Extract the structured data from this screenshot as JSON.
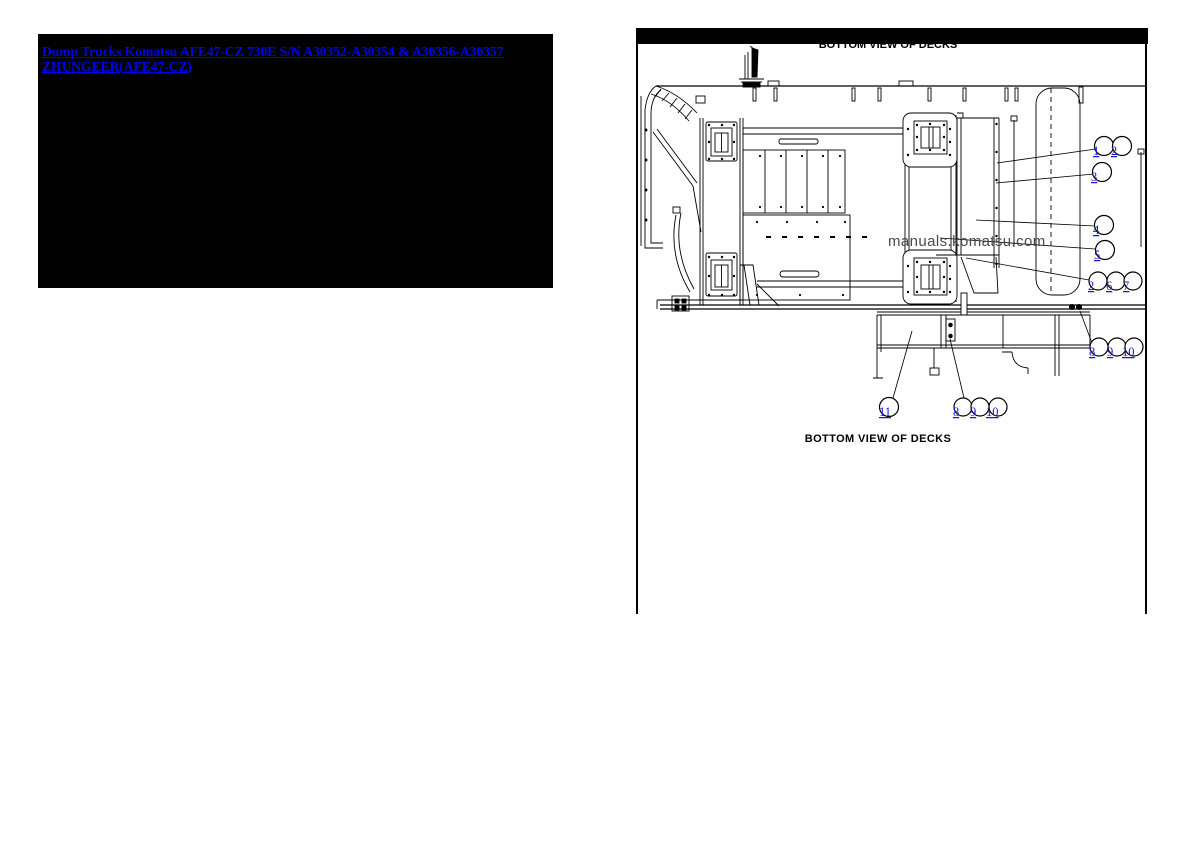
{
  "left_panel": {
    "link_text": "Dump Trucks Komatsu AFE47-CZ 730E S/N A30352-A30354 & A30356-A30357 ZHUNGEER(AFE47-CZ)"
  },
  "diagram": {
    "header_title": "BOTTOM VIEW OF DECKS",
    "caption": "BOTTOM VIEW OF DECKS",
    "watermark": "manuals.komatsu.com",
    "callouts": [
      {
        "label": "1"
      },
      {
        "label": "2"
      },
      {
        "label": "3"
      },
      {
        "label": "4"
      },
      {
        "label": "5"
      },
      {
        "label": "2"
      },
      {
        "label": "6"
      },
      {
        "label": "7"
      },
      {
        "label": "8"
      },
      {
        "label": "9"
      },
      {
        "label": "10"
      },
      {
        "label": "11"
      },
      {
        "label": "8"
      },
      {
        "label": "9"
      },
      {
        "label": "10"
      }
    ],
    "colors": {
      "link_blue": "#0000ee",
      "callout_blue": "#1818cf",
      "line_black": "#000000",
      "watermark_gray": "#4a4a4a"
    }
  }
}
